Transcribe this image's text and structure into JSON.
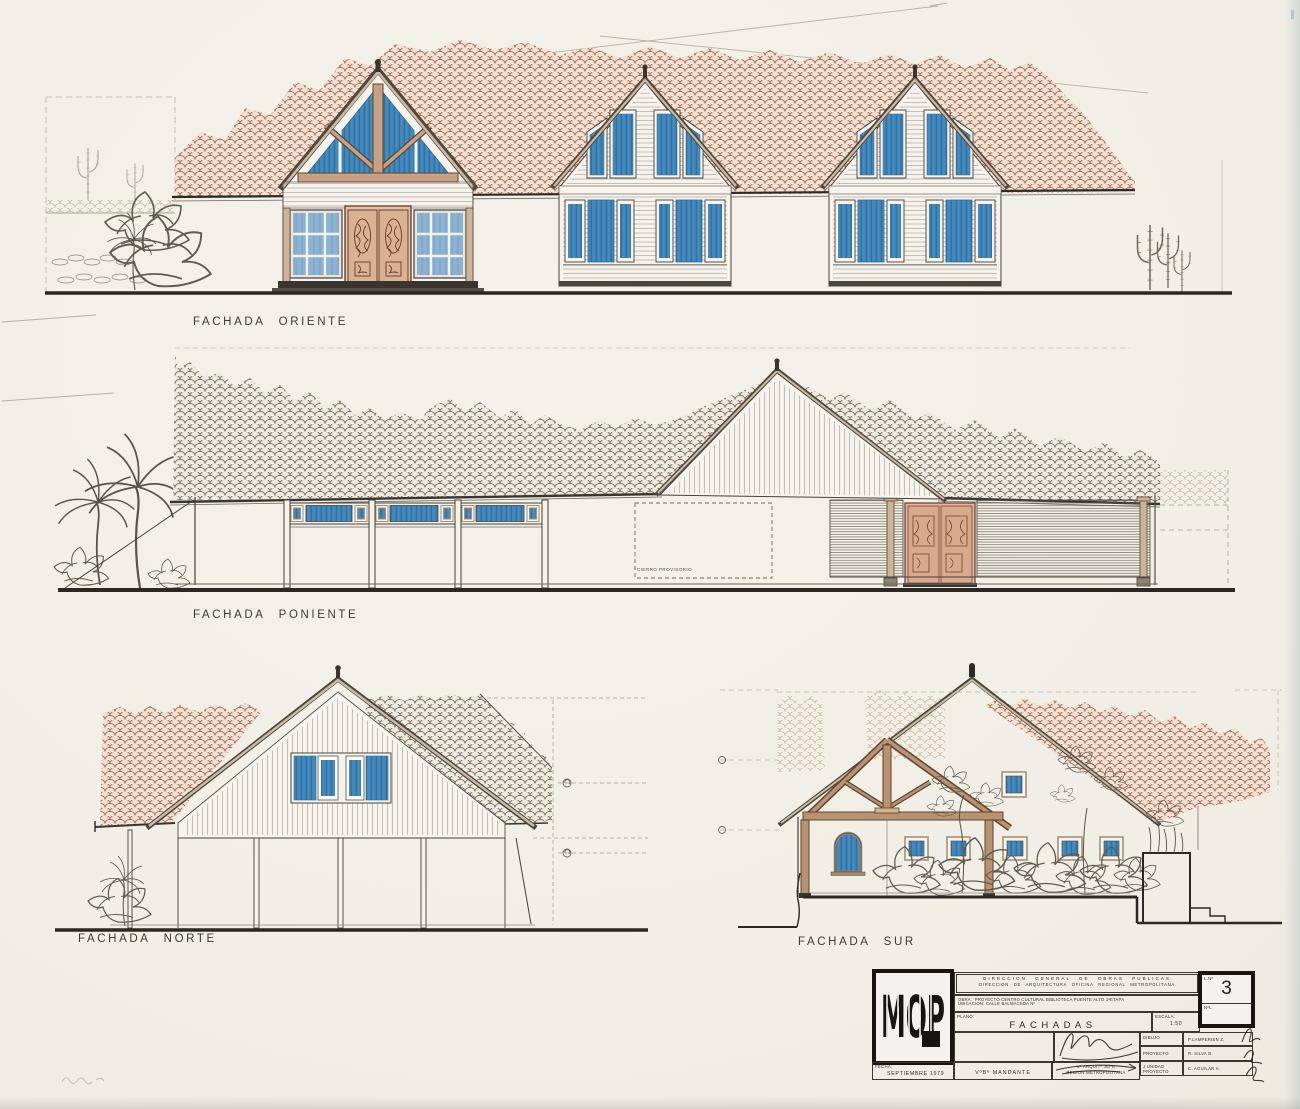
{
  "sheet": {
    "facades": {
      "oriente": "FACHADA ORIENTE",
      "poniente": "FACHADA PONIENTE",
      "norte": "FACHADA NORTE",
      "sur": "FACHADA SUR"
    },
    "annotations": {
      "cierro": "CIERRO PROVISORIO"
    },
    "title_block": {
      "logo": "MOP",
      "header_line1": "DIRECCION GENERAL DE OBRAS PUBLICAS",
      "header_line2": "DIRECCION DE ARQUITECTURA OFICINA REGIONAL METROPOLITANA",
      "obra_label": "OBRA:",
      "obra": "PROYECTO CENTRO CULTURAL BIBLIOTECA PUENTE ALTO 1ªETAPA",
      "ubicacion_label": "UBICACION:",
      "ubicacion": "CALLE BALMACEDA Nº",
      "plano_label": "PLANO:",
      "plano": "FACHADAS",
      "escala_label": "ESCALA:",
      "escala": "1:50",
      "dibujo_label": "DIBUJO",
      "dibujo": "P.LAMPERIEN Z.",
      "proyecto_label": "PROYECTO",
      "proyecto": "R. SILVA B.",
      "unidad_label": "J.UNIDAD PROYECTO",
      "unidad": "C. AGUILAR A.",
      "fecha_label": "FECHA:",
      "fecha": "SEPTIEMBRE 1979",
      "mandante": "VºBº MANDANTE",
      "visto_bueno_line1": "Vº ARQUITº JEFE",
      "visto_bueno_line2": "REGION METROPOLITANA",
      "lamina_label": "L.Nº",
      "lamina_numero": "3",
      "lamina_sub": "NºL"
    },
    "colors": {
      "paper": "#f0eee5",
      "ink": "#45413b",
      "tile_terracotta": "#a5644c",
      "glass_blue": "#3f86bb",
      "timber_tan": "#c7a183"
    }
  }
}
